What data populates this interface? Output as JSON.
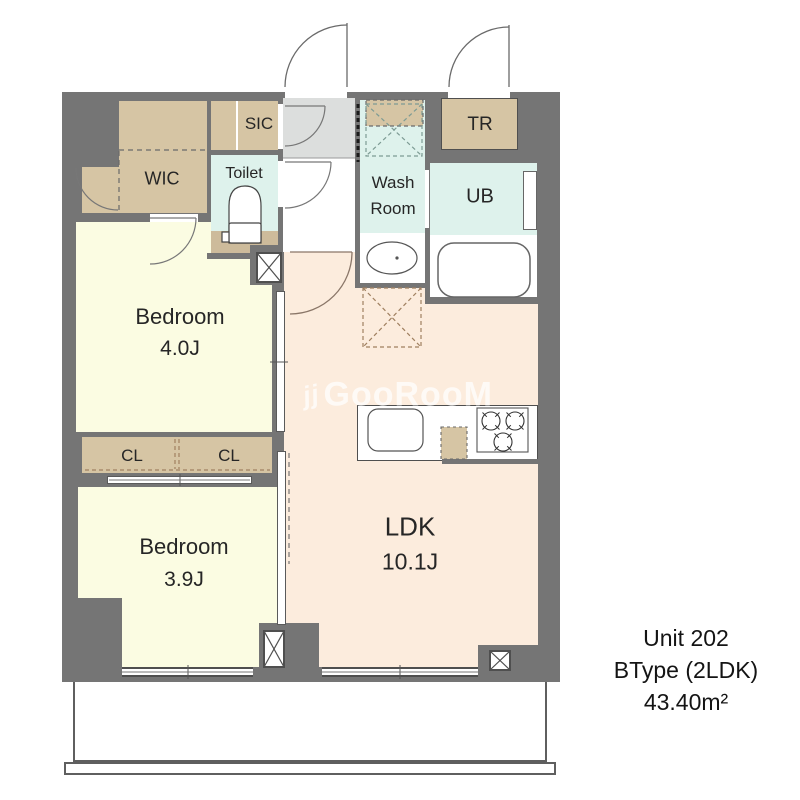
{
  "watermark": {
    "icon": "jj",
    "text": "GooRooM"
  },
  "unit_info": {
    "unit": "Unit 202",
    "type": "BType (2LDK)",
    "area": "43.40m²"
  },
  "rooms": {
    "wic": "WIC",
    "sic": "SIC",
    "toilet": "Toilet",
    "washroom_line1": "Wash",
    "washroom_line2": "Room",
    "ub": "UB",
    "tr": "TR",
    "bedroom1_name": "Bedroom",
    "bedroom1_size": "4.0J",
    "cl_left": "CL",
    "cl_right": "CL",
    "bedroom2_name": "Bedroom",
    "bedroom2_size": "3.9J",
    "ldk_name": "LDK",
    "ldk_size": "10.1J"
  },
  "fixtures": {
    "toilet": "toilet-fixture",
    "washbasin": "washbasin",
    "bathtub": "bathtub",
    "washer_space": "washing-machine-space",
    "refrigerator_space": "refrigerator-space",
    "kitchen_sink": "kitchen-sink",
    "stove": "three-burner-stove",
    "pipe_space": "pipe-space-x"
  },
  "colors": {
    "wall": "#757575",
    "closet_tan": "#d6c5a4",
    "toilet_floor_tan": "#cdbb9b",
    "wet_cyan": "#def2ec",
    "bedroom_yellow": "#fbfce2",
    "ldk_peach": "#fcecdd",
    "entry_gray": "#dcdedd"
  }
}
